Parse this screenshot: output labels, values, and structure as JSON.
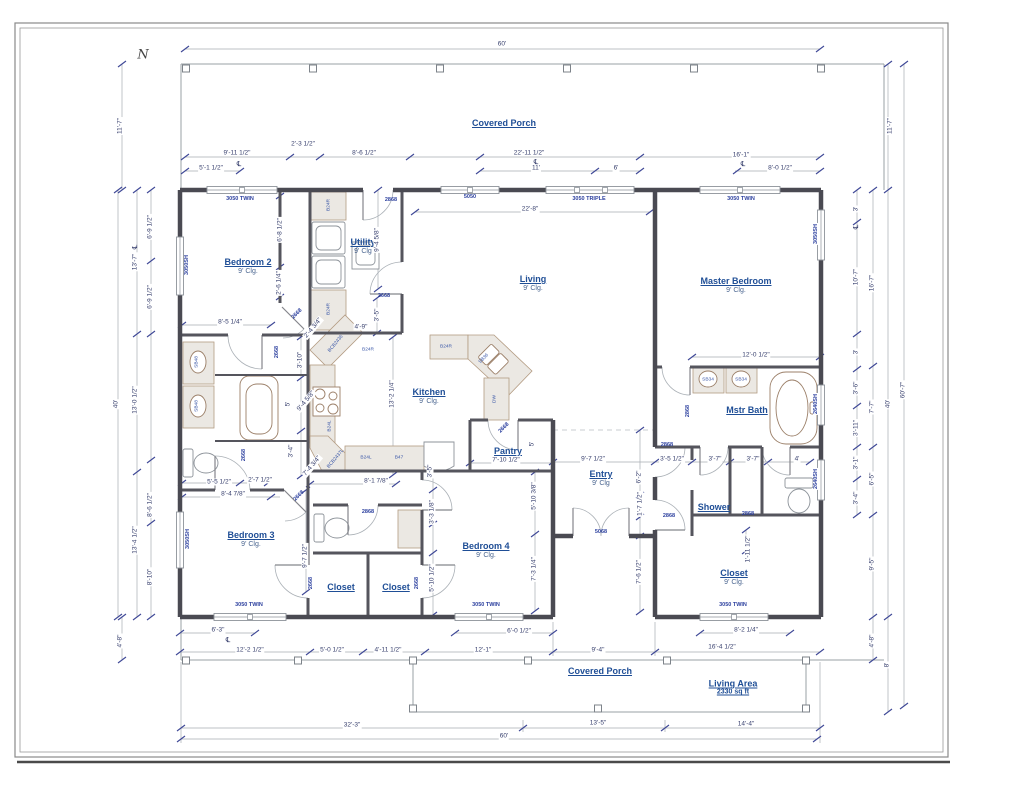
{
  "title": "Residential Floor Plan",
  "north": {
    "label": "N"
  },
  "living_area_note": {
    "label": "Living Area",
    "value": "2330 sq ft"
  },
  "rooms": [
    {
      "label": "Covered Porch",
      "x": 504,
      "y": 123
    },
    {
      "label": "Bedroom 2",
      "clg": "9' Clg.",
      "x": 248,
      "y": 266
    },
    {
      "label": "Utility",
      "clg": "9' Clg",
      "x": 363,
      "y": 246
    },
    {
      "label": "Living",
      "clg": "9' Clg.",
      "x": 533,
      "y": 283
    },
    {
      "label": "Master Bedroom",
      "clg": "9' Clg.",
      "x": 736,
      "y": 285
    },
    {
      "label": "Kitchen",
      "clg": "9' Clg.",
      "x": 429,
      "y": 396
    },
    {
      "label": "Pantry",
      "x": 508,
      "y": 451
    },
    {
      "label": "Entry",
      "clg": "9' Clg",
      "x": 601,
      "y": 478
    },
    {
      "label": "Mstr Bath",
      "x": 747,
      "y": 410
    },
    {
      "label": "Shower",
      "x": 714,
      "y": 507
    },
    {
      "label": "Bedroom 3",
      "clg": "9' Clg.",
      "x": 251,
      "y": 539
    },
    {
      "label": "Bedroom 4",
      "clg": "9' Clg.",
      "x": 486,
      "y": 550
    },
    {
      "label": "Closet",
      "x": 341,
      "y": 587
    },
    {
      "label": "Closet",
      "x": 396,
      "y": 587
    },
    {
      "label": "Closet",
      "clg": "9' Clg.",
      "x": 734,
      "y": 577
    },
    {
      "label": "Covered Porch",
      "x": 600,
      "y": 671
    },
    {
      "label": "Living Area",
      "sub": "2330 sq ft",
      "x": 733,
      "y": 687
    }
  ],
  "dims": [
    {
      "t": "60'",
      "x": 502,
      "y": 44
    },
    {
      "t": "11'-7\"",
      "x": 120,
      "y": 126,
      "r": -90
    },
    {
      "t": "11'-7\"",
      "x": 890,
      "y": 126,
      "r": -90
    },
    {
      "t": "9'-11 1/2\"",
      "x": 237,
      "y": 153
    },
    {
      "t": "5'-1 1/2\"",
      "x": 211,
      "y": 168
    },
    {
      "t": "2'-3 1/2\"",
      "x": 303,
      "y": 144
    },
    {
      "t": "8'-6 1/2\"",
      "x": 364,
      "y": 153
    },
    {
      "t": "22'-11 1/2\"",
      "x": 529,
      "y": 153
    },
    {
      "t": "11'",
      "x": 536,
      "y": 168
    },
    {
      "t": "6'",
      "x": 616,
      "y": 168
    },
    {
      "t": "16'-1\"",
      "x": 741,
      "y": 155
    },
    {
      "t": "8'-0 1/2\"",
      "x": 780,
      "y": 168
    },
    {
      "t": "22'-8\"",
      "x": 530,
      "y": 209
    },
    {
      "t": "6'-9 1/2\"",
      "x": 150,
      "y": 227,
      "r": -90
    },
    {
      "t": "13'-7\"",
      "x": 135,
      "y": 262,
      "r": -90
    },
    {
      "t": "6'-9 1/2\"",
      "x": 150,
      "y": 297,
      "r": -90
    },
    {
      "t": "13'-0 1/2\"",
      "x": 135,
      "y": 400,
      "r": -90
    },
    {
      "t": "40'",
      "x": 116,
      "y": 404,
      "r": -90
    },
    {
      "t": "8'-6 1/2\"",
      "x": 150,
      "y": 505,
      "r": -90
    },
    {
      "t": "13'-4 1/2\"",
      "x": 135,
      "y": 540,
      "r": -90
    },
    {
      "t": "8'-10\"",
      "x": 150,
      "y": 577,
      "r": -90
    },
    {
      "t": "4'-8\"",
      "x": 120,
      "y": 641,
      "r": -90
    },
    {
      "t": "3'",
      "x": 856,
      "y": 209,
      "r": -90
    },
    {
      "t": "10'-7\"",
      "x": 856,
      "y": 277,
      "r": -90
    },
    {
      "t": "16'-7\"",
      "x": 872,
      "y": 283,
      "r": -90
    },
    {
      "t": "3'",
      "x": 856,
      "y": 352,
      "r": -90
    },
    {
      "t": "3'-6\"",
      "x": 856,
      "y": 388,
      "r": -90
    },
    {
      "t": "7'-7\"",
      "x": 872,
      "y": 407,
      "r": -90
    },
    {
      "t": "3'-11\"",
      "x": 856,
      "y": 428,
      "r": -90
    },
    {
      "t": "3'-1\"",
      "x": 856,
      "y": 463,
      "r": -90
    },
    {
      "t": "6'-5\"",
      "x": 872,
      "y": 479,
      "r": -90
    },
    {
      "t": "3'-4\"",
      "x": 856,
      "y": 498,
      "r": -90
    },
    {
      "t": "9'-5\"",
      "x": 872,
      "y": 564,
      "r": -90
    },
    {
      "t": "4'-8\"",
      "x": 872,
      "y": 641,
      "r": -90
    },
    {
      "t": "40'",
      "x": 888,
      "y": 404,
      "r": -90
    },
    {
      "t": "8'",
      "x": 887,
      "y": 665,
      "r": -90
    },
    {
      "t": "60'-7\"",
      "x": 903,
      "y": 390,
      "r": -90
    },
    {
      "t": "6'-3\"",
      "x": 218,
      "y": 630
    },
    {
      "t": "12'-2 1/2\"",
      "x": 250,
      "y": 650
    },
    {
      "t": "5'-0 1/2\"",
      "x": 332,
      "y": 650
    },
    {
      "t": "4'-11 1/2\"",
      "x": 388,
      "y": 650
    },
    {
      "t": "12'-1\"",
      "x": 483,
      "y": 650
    },
    {
      "t": "6'-0 1/2\"",
      "x": 519,
      "y": 631
    },
    {
      "t": "9'-4\"",
      "x": 598,
      "y": 650
    },
    {
      "t": "16'-4 1/2\"",
      "x": 722,
      "y": 647
    },
    {
      "t": "8'-2 1/4\"",
      "x": 746,
      "y": 630
    },
    {
      "t": "32'-3\"",
      "x": 352,
      "y": 725
    },
    {
      "t": "13'-5\"",
      "x": 598,
      "y": 723
    },
    {
      "t": "14'-4\"",
      "x": 746,
      "y": 724
    },
    {
      "t": "60'",
      "x": 504,
      "y": 736
    },
    {
      "t": "8'-5 1/4\"",
      "x": 230,
      "y": 322
    },
    {
      "t": "6'-8 1/2\"",
      "x": 280,
      "y": 230,
      "r": -90
    },
    {
      "t": "2'-6 1/4\"",
      "x": 279,
      "y": 283,
      "r": -90
    },
    {
      "t": "9'-4 5/8\"",
      "x": 377,
      "y": 240,
      "r": -90
    },
    {
      "t": "3'-5\"",
      "x": 377,
      "y": 315,
      "r": -90
    },
    {
      "t": "2'-4 3/4\"",
      "x": 313,
      "y": 328,
      "r": -50
    },
    {
      "t": "4'-9\"",
      "x": 361,
      "y": 327
    },
    {
      "t": "13'-2 1/4\"",
      "x": 392,
      "y": 394,
      "r": -90
    },
    {
      "t": "9'-4 5/8\"",
      "x": 306,
      "y": 401,
      "r": -50
    },
    {
      "t": "7'-4 3/4\"",
      "x": 312,
      "y": 466,
      "r": -50
    },
    {
      "t": "8'-1 7/8\"",
      "x": 376,
      "y": 481
    },
    {
      "t": "3'-10\"",
      "x": 300,
      "y": 360,
      "r": -90
    },
    {
      "t": "5'",
      "x": 288,
      "y": 404,
      "r": -90
    },
    {
      "t": "3'-4\"",
      "x": 291,
      "y": 451,
      "r": -90
    },
    {
      "t": "5'-5 1/2\"",
      "x": 219,
      "y": 482
    },
    {
      "t": "2'-7 1/2\"",
      "x": 260,
      "y": 480
    },
    {
      "t": "8'-4 7/8\"",
      "x": 233,
      "y": 494
    },
    {
      "t": "9'-7 1/2\"",
      "x": 305,
      "y": 556,
      "r": -90
    },
    {
      "t": "3'-5\"",
      "x": 430,
      "y": 471,
      "r": -90
    },
    {
      "t": "3'-3 1/8\"",
      "x": 432,
      "y": 512,
      "r": -90
    },
    {
      "t": "5'-10 1/2\"",
      "x": 432,
      "y": 578,
      "r": -90
    },
    {
      "t": "7'-10 1/2\"",
      "x": 506,
      "y": 460
    },
    {
      "t": "5'",
      "x": 532,
      "y": 444,
      "r": -90
    },
    {
      "t": "9'-7 1/2\"",
      "x": 593,
      "y": 459
    },
    {
      "t": "3'-5 1/2\"",
      "x": 672,
      "y": 459
    },
    {
      "t": "3'-7\"",
      "x": 715,
      "y": 459
    },
    {
      "t": "3'-7\"",
      "x": 753,
      "y": 459
    },
    {
      "t": "4'",
      "x": 797,
      "y": 459
    },
    {
      "t": "12'-0 1/2\"",
      "x": 756,
      "y": 355
    },
    {
      "t": "6'-2\"",
      "x": 639,
      "y": 477,
      "r": -90
    },
    {
      "t": "1'-7 1/2\"",
      "x": 640,
      "y": 504,
      "r": -90
    },
    {
      "t": "5'-10 3/8\"",
      "x": 534,
      "y": 496,
      "r": -90
    },
    {
      "t": "7'-3 1/4\"",
      "x": 534,
      "y": 569,
      "r": -90
    },
    {
      "t": "7'-6 1/2\"",
      "x": 639,
      "y": 572,
      "r": -90
    },
    {
      "t": "1'-11 1/2\"",
      "x": 748,
      "y": 549,
      "r": -90
    }
  ],
  "tags": [
    {
      "t": "3050 TWIN",
      "x": 240,
      "y": 199,
      "k": "win"
    },
    {
      "t": "5050",
      "x": 470,
      "y": 197,
      "k": "win"
    },
    {
      "t": "3050 TRIPLE",
      "x": 589,
      "y": 199,
      "k": "win"
    },
    {
      "t": "3050 TWIN",
      "x": 741,
      "y": 199,
      "k": "win"
    },
    {
      "t": "3050SH",
      "x": 187,
      "y": 265,
      "r": -90,
      "k": "win"
    },
    {
      "t": "3050SH",
      "x": 188,
      "y": 539,
      "r": -90,
      "k": "win"
    },
    {
      "t": "3050SH",
      "x": 816,
      "y": 234,
      "r": -90,
      "k": "win"
    },
    {
      "t": "2640SH",
      "x": 816,
      "y": 404,
      "r": -90,
      "k": "win"
    },
    {
      "t": "2640SH",
      "x": 816,
      "y": 479,
      "r": -90,
      "k": "win"
    },
    {
      "t": "3050 TWIN",
      "x": 249,
      "y": 605,
      "k": "win"
    },
    {
      "t": "3050 TWIN",
      "x": 486,
      "y": 605,
      "k": "win"
    },
    {
      "t": "3050 TWIN",
      "x": 733,
      "y": 605,
      "k": "win"
    },
    {
      "t": "2868",
      "x": 391,
      "y": 200,
      "k": "door"
    },
    {
      "t": "2668",
      "x": 384,
      "y": 296,
      "k": "door"
    },
    {
      "t": "2668",
      "x": 277,
      "y": 352,
      "r": -90,
      "k": "door"
    },
    {
      "t": "2668",
      "x": 244,
      "y": 455,
      "r": -90,
      "k": "door"
    },
    {
      "t": "2668",
      "x": 297,
      "y": 314,
      "r": -45,
      "k": "door"
    },
    {
      "t": "2668",
      "x": 299,
      "y": 496,
      "r": -45,
      "k": "door"
    },
    {
      "t": "2868",
      "x": 368,
      "y": 512,
      "k": "door"
    },
    {
      "t": "2668",
      "x": 504,
      "y": 428,
      "r": -45,
      "k": "door"
    },
    {
      "t": "2668",
      "x": 311,
      "y": 583,
      "r": -90,
      "k": "door"
    },
    {
      "t": "2668",
      "x": 417,
      "y": 583,
      "r": -90,
      "k": "door"
    },
    {
      "t": "5068",
      "x": 601,
      "y": 532,
      "k": "door"
    },
    {
      "t": "2868",
      "x": 667,
      "y": 445,
      "k": "door"
    },
    {
      "t": "2868",
      "x": 669,
      "y": 516,
      "k": "door"
    },
    {
      "t": "2868",
      "x": 688,
      "y": 411,
      "r": -90,
      "k": "door"
    },
    {
      "t": "2868",
      "x": 748,
      "y": 514,
      "k": "door"
    },
    {
      "t": "B24R",
      "x": 329,
      "y": 205,
      "r": -90,
      "k": "cab"
    },
    {
      "t": "B24R",
      "x": 329,
      "y": 309,
      "r": -90,
      "k": "cab"
    },
    {
      "t": "BCB2436",
      "x": 336,
      "y": 344,
      "r": -50,
      "k": "cab"
    },
    {
      "t": "B24R",
      "x": 368,
      "y": 350,
      "k": "cab"
    },
    {
      "t": "B24R",
      "x": 446,
      "y": 347,
      "k": "cab"
    },
    {
      "t": "SB36",
      "x": 484,
      "y": 359,
      "r": -45,
      "k": "cab"
    },
    {
      "t": "DW",
      "x": 495,
      "y": 399,
      "r": -90,
      "k": "cab"
    },
    {
      "t": "B24L",
      "x": 330,
      "y": 426,
      "r": -90,
      "k": "cab"
    },
    {
      "t": "BCB2437L",
      "x": 336,
      "y": 459,
      "r": -50,
      "k": "cab"
    },
    {
      "t": "B24L",
      "x": 366,
      "y": 458,
      "k": "cab"
    },
    {
      "t": "B47",
      "x": 399,
      "y": 458,
      "k": "cab"
    },
    {
      "t": "SB48",
      "x": 197,
      "y": 362,
      "r": -90,
      "k": "cab"
    },
    {
      "t": "SB48",
      "x": 197,
      "y": 406,
      "r": -90,
      "k": "cab"
    },
    {
      "t": "SB34",
      "x": 708,
      "y": 380,
      "k": "cab"
    },
    {
      "t": "SB34",
      "x": 741,
      "y": 380,
      "k": "cab"
    },
    {
      "t": "℄",
      "x": 239,
      "y": 164,
      "k": "cl"
    },
    {
      "t": "℄",
      "x": 536,
      "y": 162,
      "k": "cl"
    },
    {
      "t": "℄",
      "x": 743,
      "y": 164,
      "k": "cl"
    },
    {
      "t": "℄",
      "x": 228,
      "y": 640,
      "k": "cl"
    },
    {
      "t": "℄",
      "x": 135,
      "y": 247,
      "r": -90,
      "k": "cl"
    },
    {
      "t": "℄",
      "x": 856,
      "y": 227,
      "r": -90,
      "k": "cl"
    }
  ]
}
